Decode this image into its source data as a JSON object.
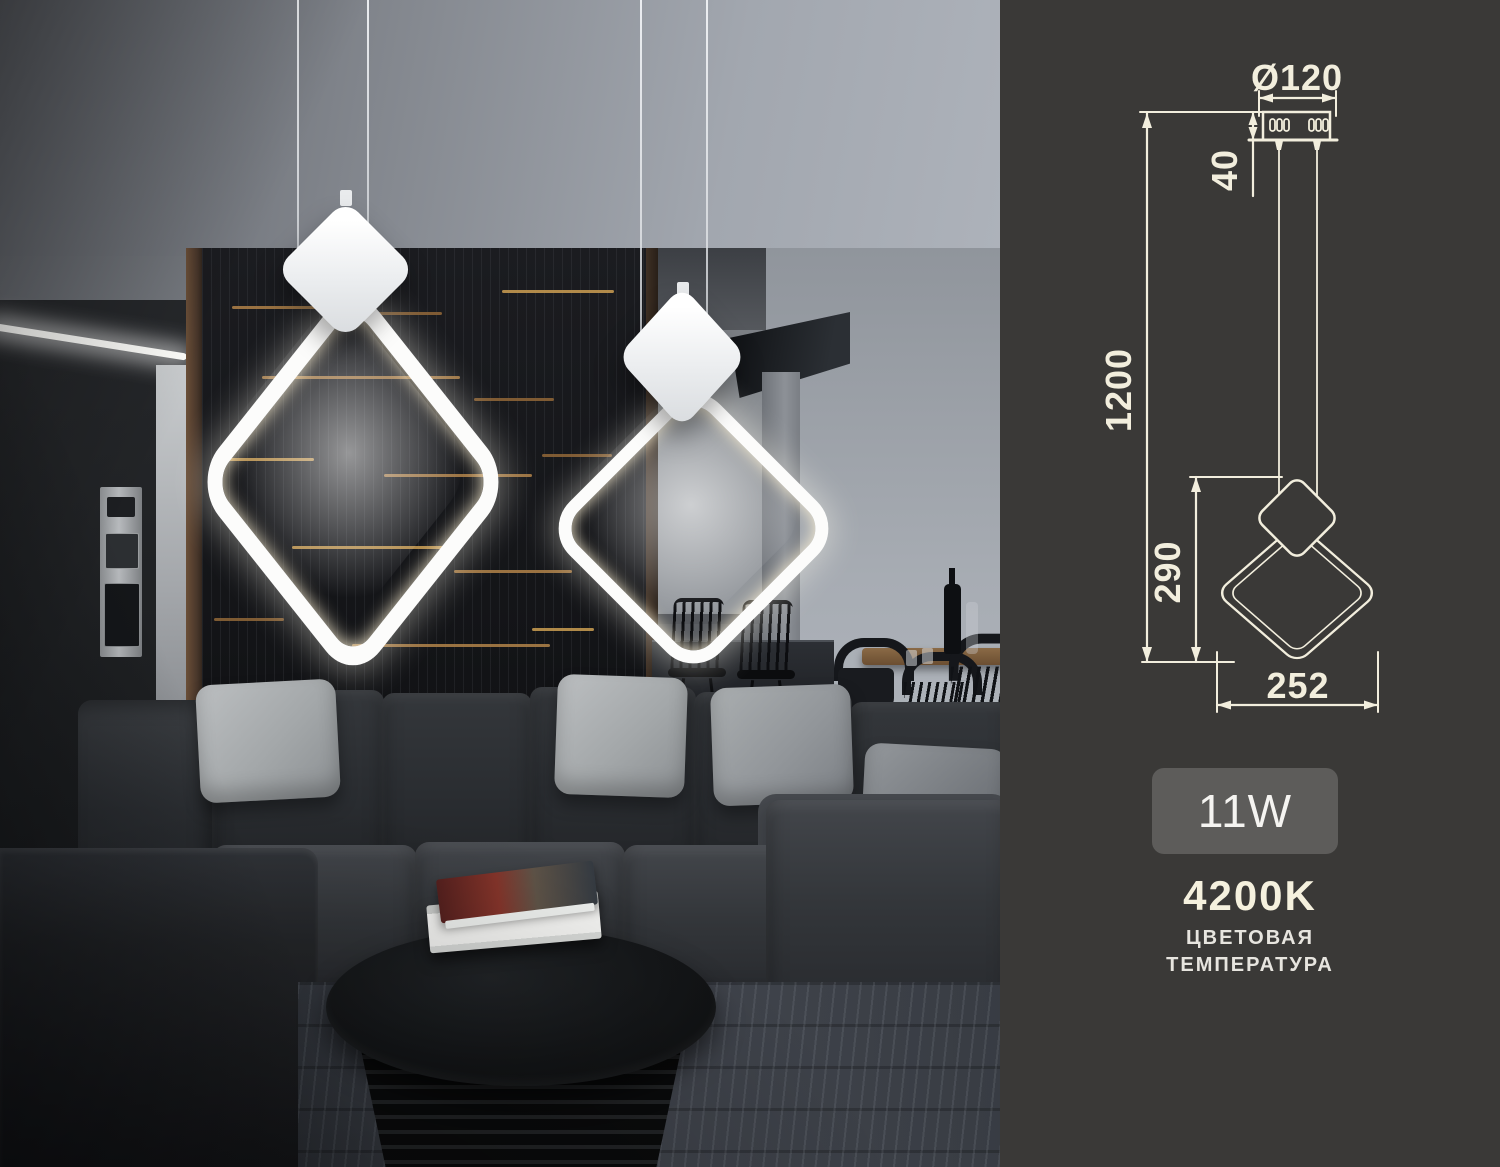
{
  "right_panel": {
    "background_color": "#3a3937",
    "line_color": "#f2eedd",
    "diagram": {
      "diameter_label": "Ø120",
      "canopy_height_label": "40",
      "suspension_length_label": "1200",
      "fixture_height_label": "290",
      "fixture_width_label": "252"
    },
    "power_badge": {
      "label": "11W",
      "background_color": "#5d5c5a",
      "text_color": "#f5f4f1"
    },
    "color_temperature": {
      "value": "4200K",
      "caption_line1": "ЦВЕТОВАЯ",
      "caption_line2": "ТЕМПЕРАТУРА"
    },
    "features": [
      {
        "icon": "shield-check-icon",
        "caption_line1": "50.000 ЧАСОВ",
        "caption_line2": "РАБОТЫ"
      },
      {
        "icon": "eye-icon",
        "caption_line1": "МЯГКИЙ СВЕТ",
        "caption_line2": "ЗАЩИТА ГЛАЗ"
      }
    ]
  }
}
